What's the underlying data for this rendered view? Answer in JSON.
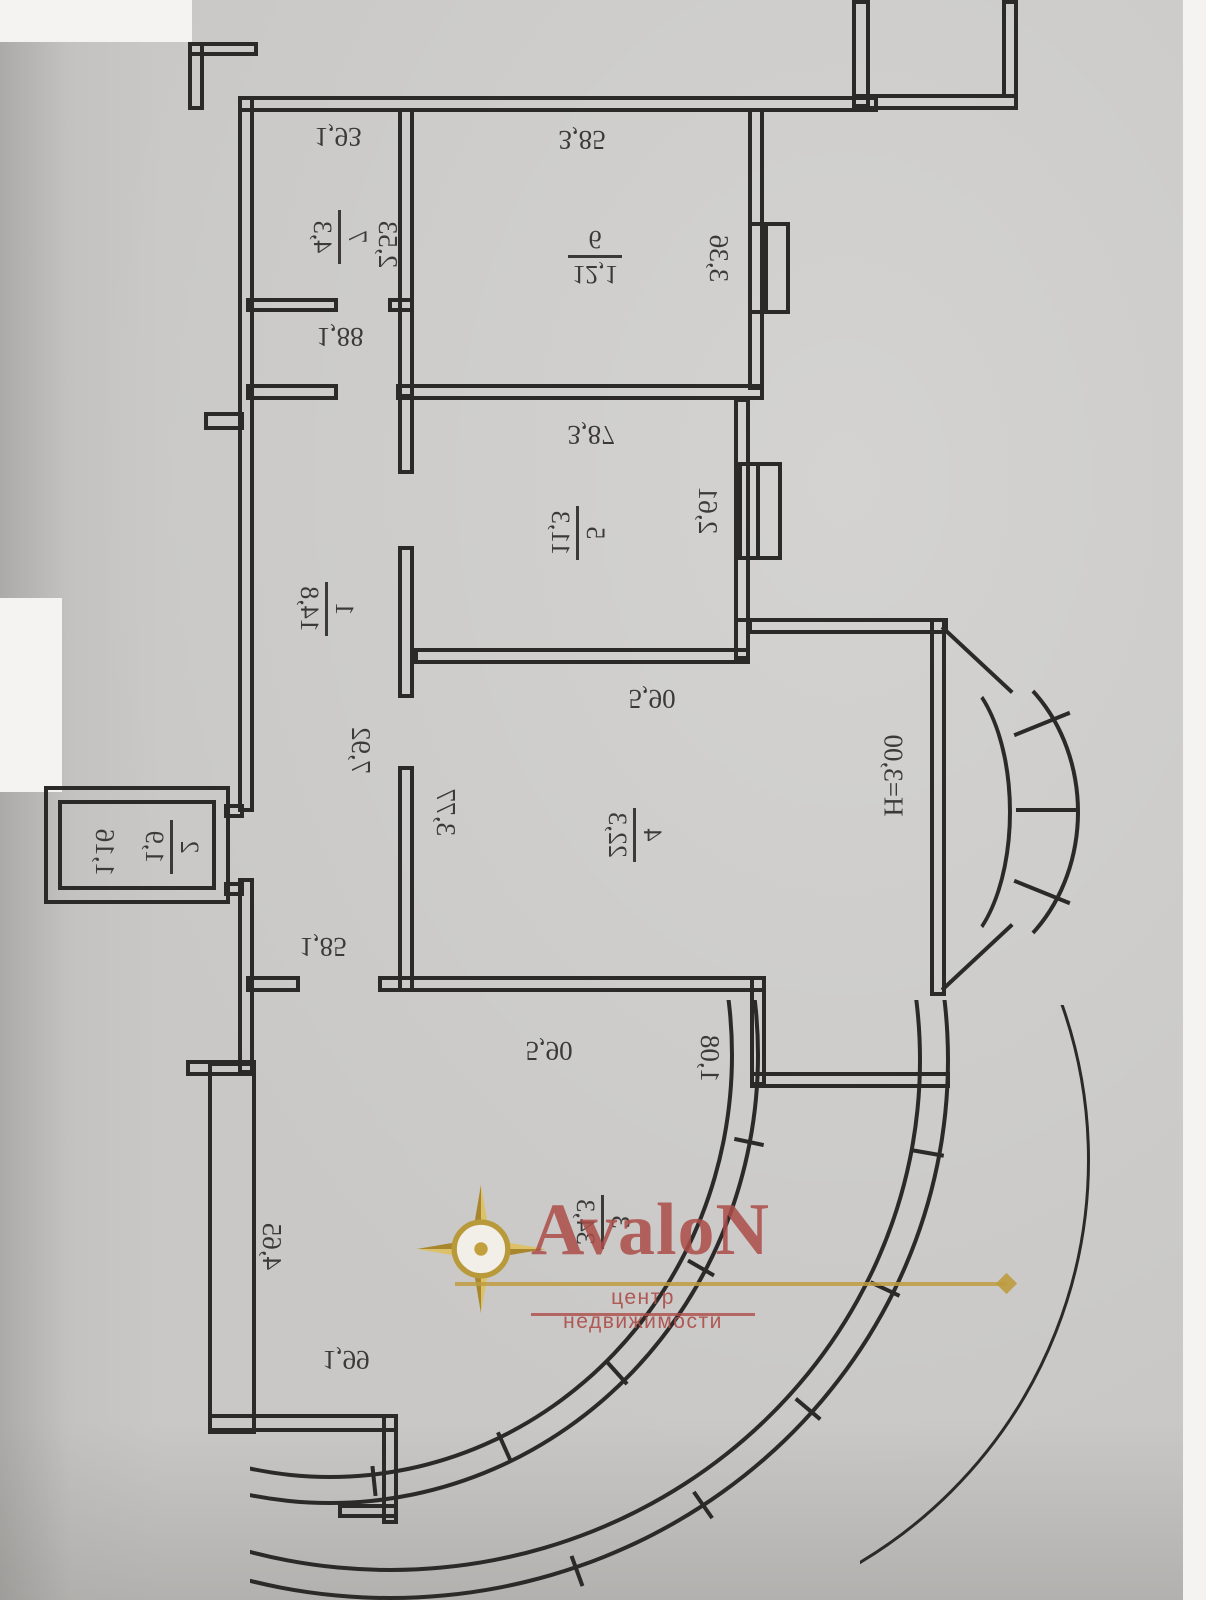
{
  "watermark": {
    "brand": "AvaloN",
    "tagline": "центр недвижимости"
  },
  "colors": {
    "ink": "#2b2a28",
    "paper": "#c9c8c6",
    "brand_red": "#ae4e4a",
    "gold": "#bf9c3f"
  },
  "plan": {
    "ceiling_height": "Н=3,00",
    "rooms": {
      "corridor": {
        "number": "1",
        "area": "14,8",
        "length": "7,92",
        "door": "1,85"
      },
      "wc": {
        "number": "2",
        "area": "1,9",
        "width": "1,16"
      },
      "living": {
        "number": "3",
        "area": "34,3",
        "width": "5,90",
        "step": "1,08",
        "side": "4,65",
        "bottom": "1,99"
      },
      "room4": {
        "number": "4",
        "area": "22,3",
        "width": "5,90",
        "side": "3,77"
      },
      "room5": {
        "number": "5",
        "area": "11,3",
        "width": "3,87",
        "window": "2,61"
      },
      "kitchen": {
        "number": "6",
        "area": "12,1",
        "width": "3,85",
        "window": "3,36"
      },
      "bathroom": {
        "number": "7",
        "area": "4,3",
        "width": "1,93",
        "depth": "2,53"
      },
      "hall": {
        "width": "1,88"
      }
    }
  }
}
